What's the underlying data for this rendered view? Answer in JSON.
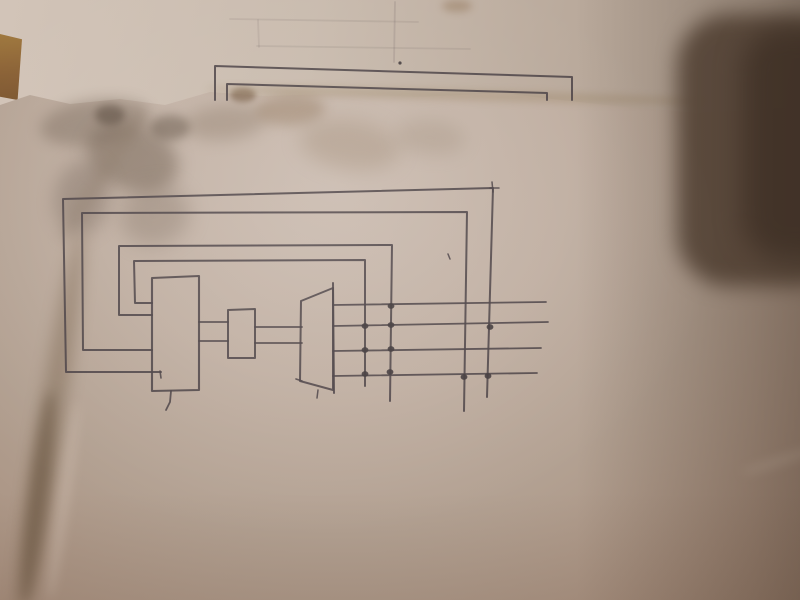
{
  "palette": {
    "pen": "#4c4347",
    "pen_dark": "#413a3c",
    "paper_front": "#b2a091",
    "paper_back": "#c4b5a8",
    "table": "#8a6136",
    "shadow": "#544335"
  },
  "drawing": {
    "polylines": [
      {
        "name": "back-sheet-outline-outer",
        "pts": [
          [
            215,
            100
          ],
          [
            215,
            66
          ],
          [
            572,
            77
          ],
          [
            572,
            100
          ]
        ],
        "w": 2
      },
      {
        "name": "back-sheet-outline-inner",
        "pts": [
          [
            227,
            100
          ],
          [
            227,
            84
          ],
          [
            547,
            93
          ],
          [
            547,
            100
          ]
        ],
        "w": 2
      },
      {
        "name": "faint-pencil-line",
        "pts": [
          [
            395,
            2
          ],
          [
            394,
            62
          ]
        ],
        "o": 0.14
      },
      {
        "name": "faint-pencil-line",
        "pts": [
          [
            230,
            19
          ],
          [
            418,
            22
          ]
        ],
        "o": 0.1
      },
      {
        "name": "faint-pencil-line",
        "pts": [
          [
            258,
            20
          ],
          [
            259,
            47
          ]
        ],
        "o": 0.1
      },
      {
        "name": "faint-pencil-line",
        "pts": [
          [
            257,
            46
          ],
          [
            470,
            49
          ]
        ],
        "o": 0.1
      },
      {
        "name": "loop-line-outer",
        "pts": [
          [
            161,
            372
          ],
          [
            66,
            372
          ],
          [
            63,
            199
          ],
          [
            493,
            188
          ],
          [
            487,
            397
          ]
        ],
        "w": 2
      },
      {
        "name": "loop-line-outer-hook",
        "pts": [
          [
            160,
            371
          ],
          [
            161,
            378
          ]
        ],
        "w": 1.6
      },
      {
        "name": "corner-overshoot-v",
        "pts": [
          [
            492,
            182
          ],
          [
            493,
            192
          ]
        ],
        "w": 1.5
      },
      {
        "name": "corner-overshoot-h",
        "pts": [
          [
            490,
            188
          ],
          [
            499,
            188
          ]
        ],
        "w": 1.5
      },
      {
        "name": "loop-line-2",
        "pts": [
          [
            152,
            350
          ],
          [
            83,
            350
          ],
          [
            82,
            213
          ],
          [
            467,
            212
          ],
          [
            464,
            411
          ]
        ],
        "w": 2
      },
      {
        "name": "loop-line-3",
        "pts": [
          [
            152,
            315
          ],
          [
            119,
            315
          ],
          [
            119,
            246
          ],
          [
            392,
            245
          ],
          [
            390,
            401
          ]
        ],
        "w": 2
      },
      {
        "name": "loop-line-inner",
        "pts": [
          [
            152,
            303
          ],
          [
            135,
            303
          ],
          [
            134,
            261
          ],
          [
            365,
            260
          ],
          [
            365,
            386
          ]
        ],
        "w": 2
      },
      {
        "name": "cpu-block",
        "pts": [
          [
            152,
            278
          ],
          [
            199,
            276
          ],
          [
            199,
            390
          ],
          [
            152,
            391
          ],
          [
            152,
            278
          ]
        ],
        "w": 2.1
      },
      {
        "name": "cpu-block-stub",
        "pts": [
          [
            171,
            391
          ],
          [
            170,
            402
          ],
          [
            166,
            410
          ]
        ],
        "w": 1.8
      },
      {
        "name": "latch-block",
        "pts": [
          [
            228,
            310
          ],
          [
            255,
            309
          ],
          [
            255,
            358
          ],
          [
            228,
            358
          ],
          [
            228,
            310
          ]
        ],
        "w": 2
      },
      {
        "name": "driver-block",
        "pts": [
          [
            301,
            301
          ],
          [
            333,
            288
          ],
          [
            333,
            390
          ],
          [
            300,
            381
          ],
          [
            301,
            301
          ]
        ],
        "w": 2
      },
      {
        "name": "driver-right-edge-overshoot",
        "pts": [
          [
            333,
            283
          ],
          [
            334,
            393
          ]
        ],
        "w": 2
      },
      {
        "name": "driver-bottom-overshoot",
        "pts": [
          [
            296,
            379
          ],
          [
            302,
            381
          ]
        ],
        "w": 1.6
      },
      {
        "name": "driver-bottom-tick",
        "pts": [
          [
            318,
            390
          ],
          [
            317,
            398
          ]
        ],
        "w": 1.5
      },
      {
        "name": "connector-line",
        "pts": [
          [
            199,
            322
          ],
          [
            228,
            322
          ]
        ],
        "w": 1.8
      },
      {
        "name": "connector-line",
        "pts": [
          [
            199,
            341
          ],
          [
            228,
            341
          ]
        ],
        "w": 1.8
      },
      {
        "name": "connector-line",
        "pts": [
          [
            255,
            327
          ],
          [
            302,
            327
          ]
        ],
        "w": 1.8
      },
      {
        "name": "connector-line",
        "pts": [
          [
            255,
            343
          ],
          [
            302,
            343
          ]
        ],
        "w": 1.8
      },
      {
        "name": "bus-line-1",
        "pts": [
          [
            333,
            305
          ],
          [
            546,
            302
          ]
        ],
        "w": 1.8
      },
      {
        "name": "bus-line-2",
        "pts": [
          [
            333,
            326
          ],
          [
            548,
            322
          ]
        ],
        "w": 1.8
      },
      {
        "name": "bus-line-3",
        "pts": [
          [
            333,
            351
          ],
          [
            541,
            348
          ]
        ],
        "w": 1.8
      },
      {
        "name": "bus-line-4",
        "pts": [
          [
            333,
            376
          ],
          [
            537,
            373
          ]
        ],
        "w": 1.8
      },
      {
        "name": "stray-mark",
        "pts": [
          [
            448,
            254
          ],
          [
            450,
            259
          ]
        ],
        "w": 1.5
      }
    ],
    "dots": [
      {
        "x": 391,
        "y": 306
      },
      {
        "x": 365,
        "y": 326
      },
      {
        "x": 391,
        "y": 325
      },
      {
        "x": 490,
        "y": 327
      },
      {
        "x": 365,
        "y": 350
      },
      {
        "x": 391,
        "y": 349
      },
      {
        "x": 365,
        "y": 374
      },
      {
        "x": 390,
        "y": 372
      },
      {
        "x": 464,
        "y": 377
      },
      {
        "x": 488,
        "y": 376
      },
      {
        "x": 400,
        "y": 63,
        "rx": 1.6,
        "ry": 1.6
      }
    ]
  },
  "stains": [
    {
      "x": 40,
      "y": 100,
      "w": 110,
      "h": 45,
      "rot": -8,
      "color": "#7a6a5c",
      "op": 0.45,
      "blur": 7
    },
    {
      "x": 85,
      "y": 125,
      "w": 95,
      "h": 65,
      "rot": 20,
      "color": "#6e5d4e",
      "op": 0.5,
      "blur": 8
    },
    {
      "x": 55,
      "y": 160,
      "w": 55,
      "h": 75,
      "rot": 10,
      "color": "#75655a",
      "op": 0.4,
      "blur": 9
    },
    {
      "x": 120,
      "y": 185,
      "w": 70,
      "h": 60,
      "rot": -15,
      "color": "#7d6c5e",
      "op": 0.35,
      "blur": 10
    },
    {
      "x": 185,
      "y": 105,
      "w": 80,
      "h": 35,
      "rot": -5,
      "color": "#8a7765",
      "op": 0.4,
      "blur": 8
    },
    {
      "x": 255,
      "y": 95,
      "w": 70,
      "h": 30,
      "rot": -3,
      "color": "#93795f",
      "op": 0.45,
      "blur": 6
    },
    {
      "x": 300,
      "y": 120,
      "w": 100,
      "h": 50,
      "rot": 8,
      "color": "#99836c",
      "op": 0.35,
      "blur": 10
    },
    {
      "x": 395,
      "y": 120,
      "w": 70,
      "h": 35,
      "rot": 5,
      "color": "#9a8874",
      "op": 0.3,
      "blur": 9
    },
    {
      "x": 230,
      "y": 88,
      "w": 26,
      "h": 14,
      "rot": 0,
      "color": "#6b4f35",
      "op": 0.55,
      "blur": 3
    },
    {
      "x": 150,
      "y": 115,
      "w": 40,
      "h": 25,
      "rot": 0,
      "color": "#5f5042",
      "op": 0.5,
      "blur": 5
    },
    {
      "x": 95,
      "y": 105,
      "w": 30,
      "h": 20,
      "rot": 0,
      "color": "#55463a",
      "op": 0.55,
      "blur": 4
    },
    {
      "x": 442,
      "y": 0,
      "w": 30,
      "h": 12,
      "rot": 0,
      "color": "#8a6a4a",
      "op": 0.4,
      "blur": 4
    }
  ],
  "creases": [
    {
      "x": 38,
      "y": 228,
      "w": 24,
      "h": 395,
      "rot": 9,
      "color": "#6d573f",
      "op": 0.4,
      "blur": 8
    },
    {
      "x": 28,
      "y": 390,
      "w": 20,
      "h": 215,
      "rot": 7,
      "color": "#63503c",
      "op": 0.5,
      "blur": 6
    },
    {
      "x": 95,
      "y": 95,
      "w": 14,
      "h": 160,
      "rot": 32,
      "color": "#8d7a68",
      "op": 0.35,
      "blur": 6
    },
    {
      "x": 205,
      "y": 90,
      "w": 500,
      "h": 10,
      "rot": 1.5,
      "color": "#907751",
      "op": 0.3,
      "blur": 4
    },
    {
      "x": 740,
      "y": 455,
      "w": 90,
      "h": 8,
      "rot": -18,
      "color": "#cdbaa9",
      "op": 0.5,
      "blur": 5
    },
    {
      "x": 58,
      "y": 400,
      "w": 12,
      "h": 200,
      "rot": 8,
      "color": "#cbb9ab",
      "op": 0.45,
      "blur": 5
    }
  ]
}
